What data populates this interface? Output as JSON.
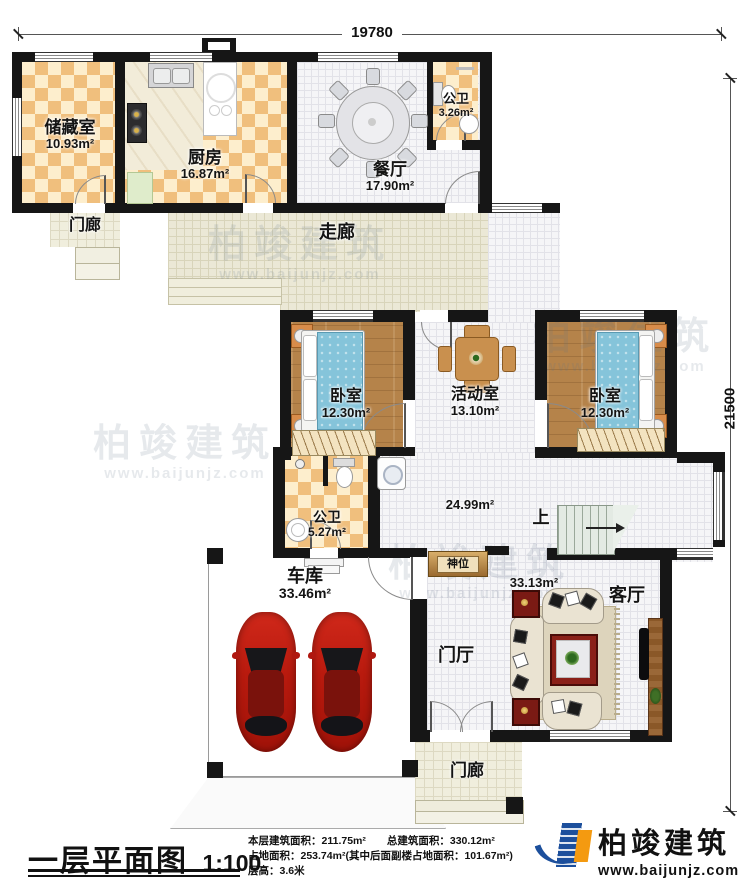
{
  "plan": {
    "dim_top": "19780",
    "dim_right": "21500",
    "rooms": {
      "storage": {
        "name": "储藏室",
        "area": "10.93m²"
      },
      "kitchen": {
        "name": "厨房",
        "area": "16.87m²"
      },
      "dining": {
        "name": "餐厅",
        "area": "17.90m²"
      },
      "bath_top": {
        "name": "公卫",
        "area": "3.26m²"
      },
      "porch_top": {
        "name": "门廊"
      },
      "corridor": {
        "name": "走廊"
      },
      "bedroom_left": {
        "name": "卧室",
        "area": "12.30m²"
      },
      "activity": {
        "name": "活动室",
        "area": "13.10m²"
      },
      "bedroom_right": {
        "name": "卧室",
        "area": "12.30m²"
      },
      "bath_mid": {
        "name": "公卫",
        "area": "5.27m²"
      },
      "open_area": {
        "area": "24.99m²"
      },
      "stairs": {
        "label": "上"
      },
      "shrine": {
        "name": "神位"
      },
      "garage": {
        "name": "车库",
        "area": "33.46m²"
      },
      "living": {
        "name": "客厅",
        "area": "33.13m²"
      },
      "foyer": {
        "name": "门厅"
      },
      "porch_bottom": {
        "name": "门廊"
      }
    },
    "watermark": {
      "brand": "柏竣建筑",
      "url": "www.baijunjz.com"
    }
  },
  "footer": {
    "title": "一层平面图",
    "scale": "1:100",
    "stats": {
      "line1": "本层建筑面积：211.75m²　　总建筑面积：330.12m²",
      "line2": "占地面积：253.74m²(其中后面副楼占地面积：101.67m²)",
      "line3": "层高：3.6米"
    },
    "logo": {
      "brand": "柏竣建筑",
      "url": "www.baijunjz.com"
    }
  }
}
